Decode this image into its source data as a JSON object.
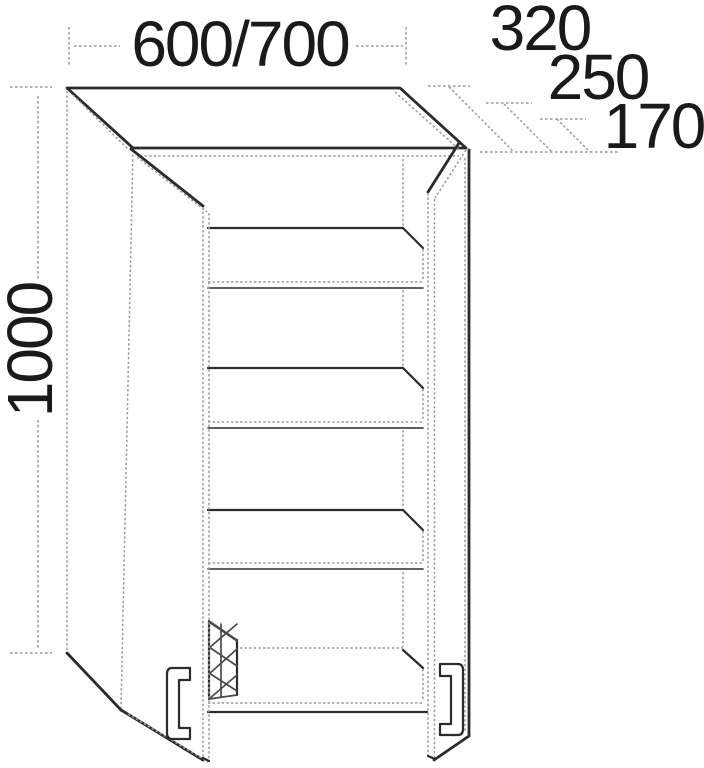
{
  "drawing": {
    "width_dimension": "600/700",
    "height_dimension": "1000",
    "depth_dimensions": [
      "320",
      "250",
      "170"
    ],
    "colors": {
      "background": "#ffffff",
      "outline": "#2b2b2b",
      "thin_line": "#9a9a9a",
      "text": "#1a1a1a"
    }
  }
}
